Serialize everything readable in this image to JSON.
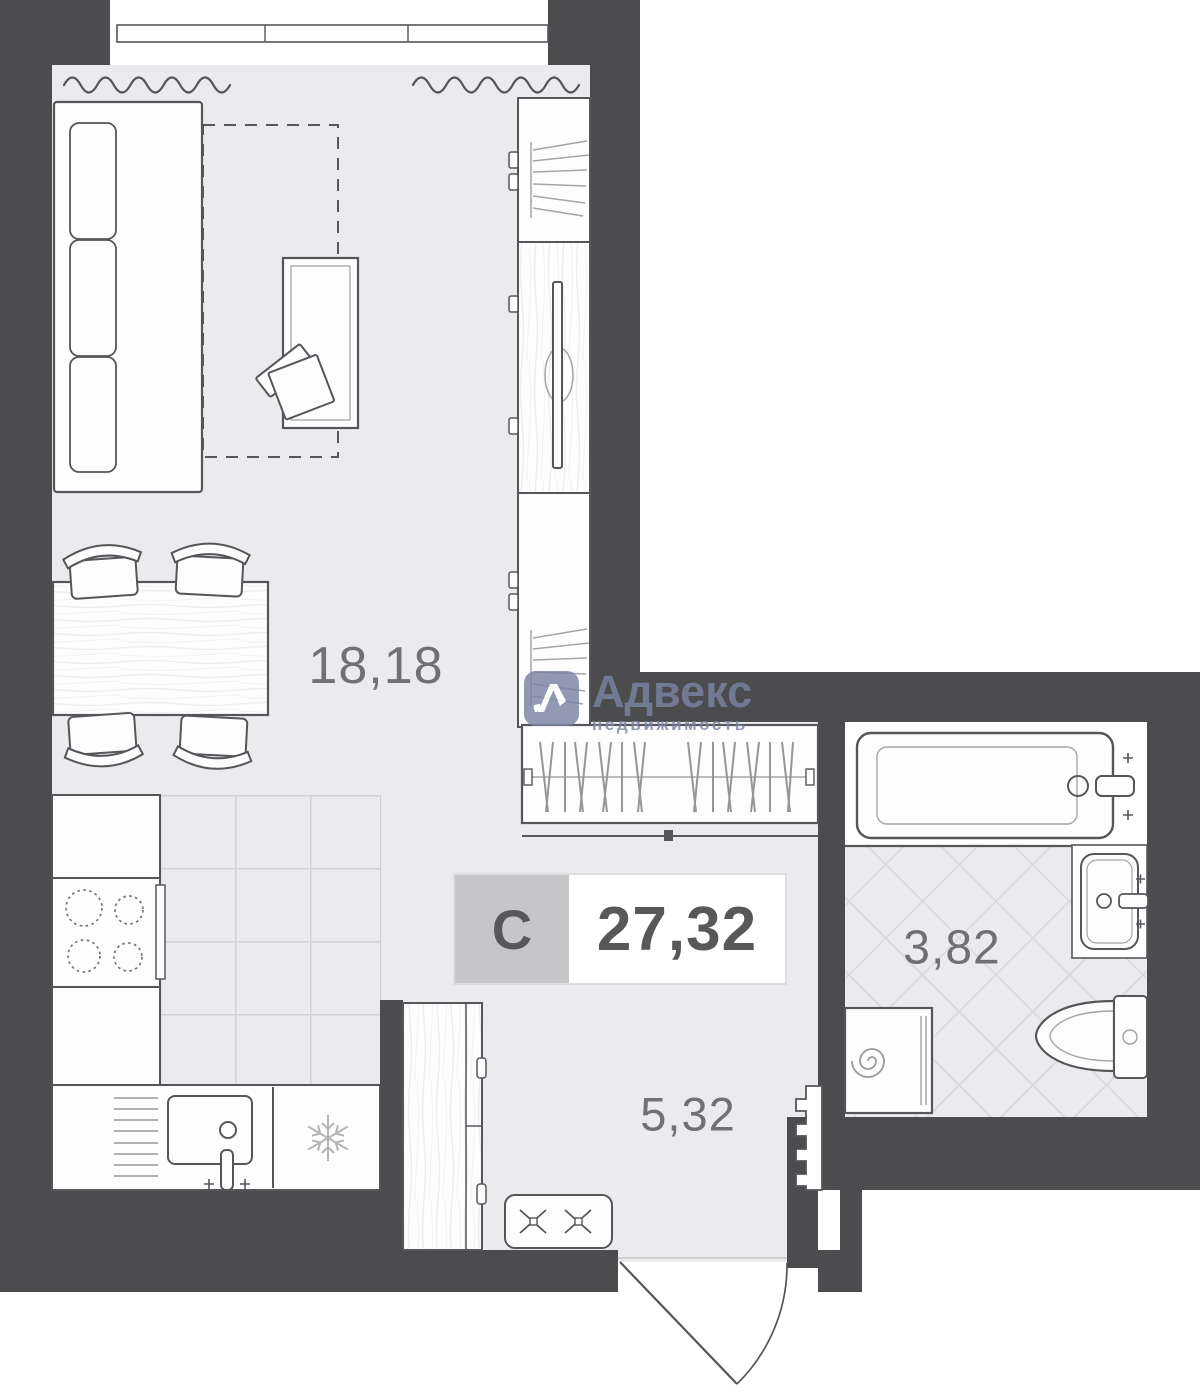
{
  "plan": {
    "type_letter": "С",
    "total_area": "27,32",
    "rooms": {
      "living": {
        "area": "18,18"
      },
      "hallway": {
        "area": "5,32"
      },
      "bathroom": {
        "area": "3,82"
      }
    }
  },
  "watermark": {
    "brand": "Адвекс",
    "subtitle": "недвижимость"
  },
  "colors": {
    "wall": "#4c4c4e",
    "floor": "#ebebed",
    "line": "#55565a",
    "line_light": "#a5a5a8",
    "area_text": "#707174",
    "label_bg": "#c6c6c8",
    "label_border": "#dddde0",
    "label_text": "#58585b",
    "watermark": "#7a84a3"
  }
}
